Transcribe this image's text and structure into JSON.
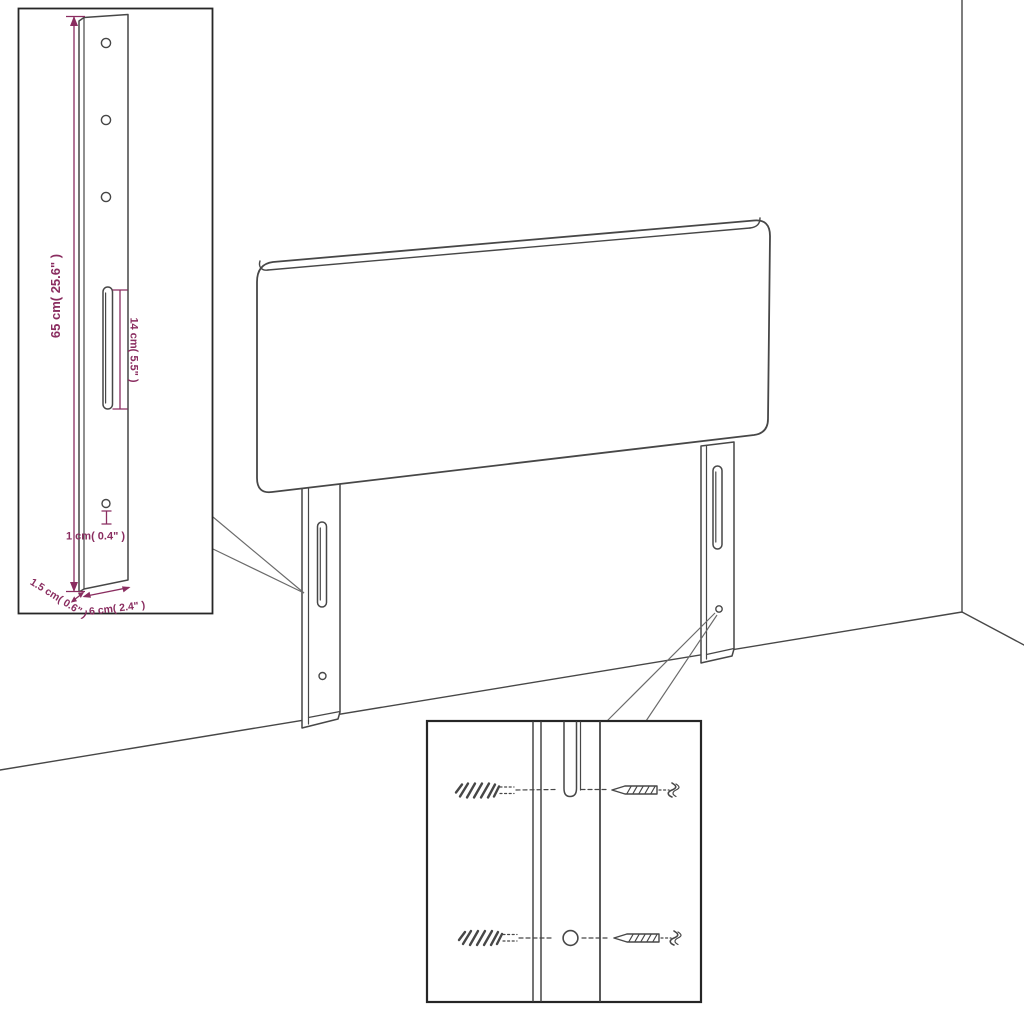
{
  "colors": {
    "line": "#474747",
    "inset_border": "#262626",
    "dimension": "#8a2d60",
    "background": "#ffffff",
    "callout": "#6a6a6a"
  },
  "bracket_inset": {
    "height_label": "65 cm( 25.6\" )",
    "slot_label": "14 cm( 5.5\" )",
    "hole_label": "1 cm( 0.4\" )",
    "depth_label": "1.5 cm( 0.6\" )",
    "width_label": "6 cm( 2.4\" )"
  }
}
